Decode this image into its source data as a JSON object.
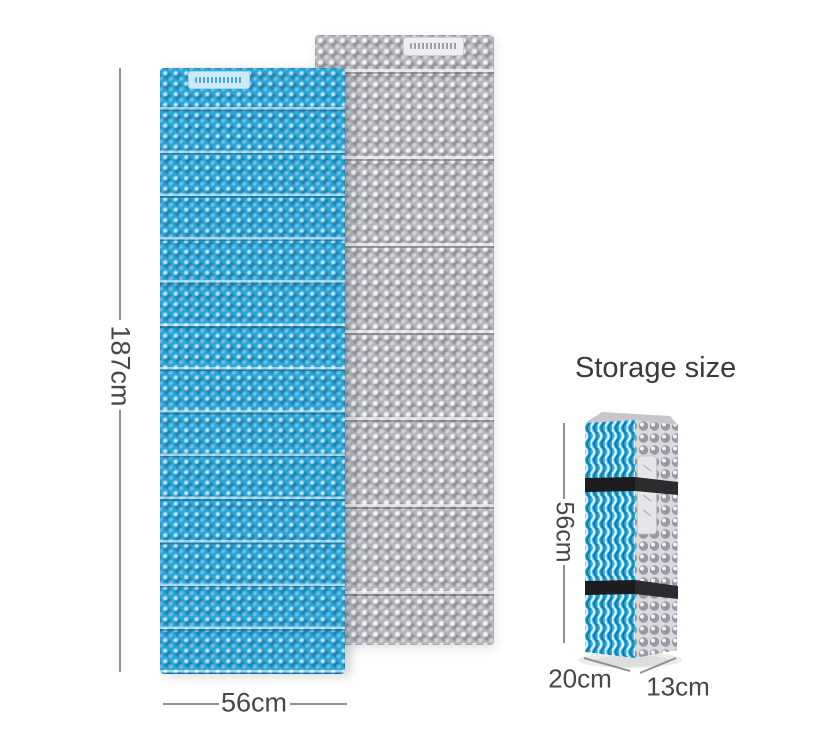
{
  "main_mat": {
    "height_label": "187cm",
    "width_label": "56cm"
  },
  "storage": {
    "title": "Storage size",
    "height_label": "56cm",
    "depth_label": "20cm",
    "width_label": "13cm"
  },
  "colors": {
    "mat_blue": "#2ba6d9",
    "mat_gray": "#b6b6bd",
    "strap_black": "#1d1d1f",
    "dimension_line": "#909090",
    "dimension_text": "#474747",
    "background": "#ffffff"
  }
}
